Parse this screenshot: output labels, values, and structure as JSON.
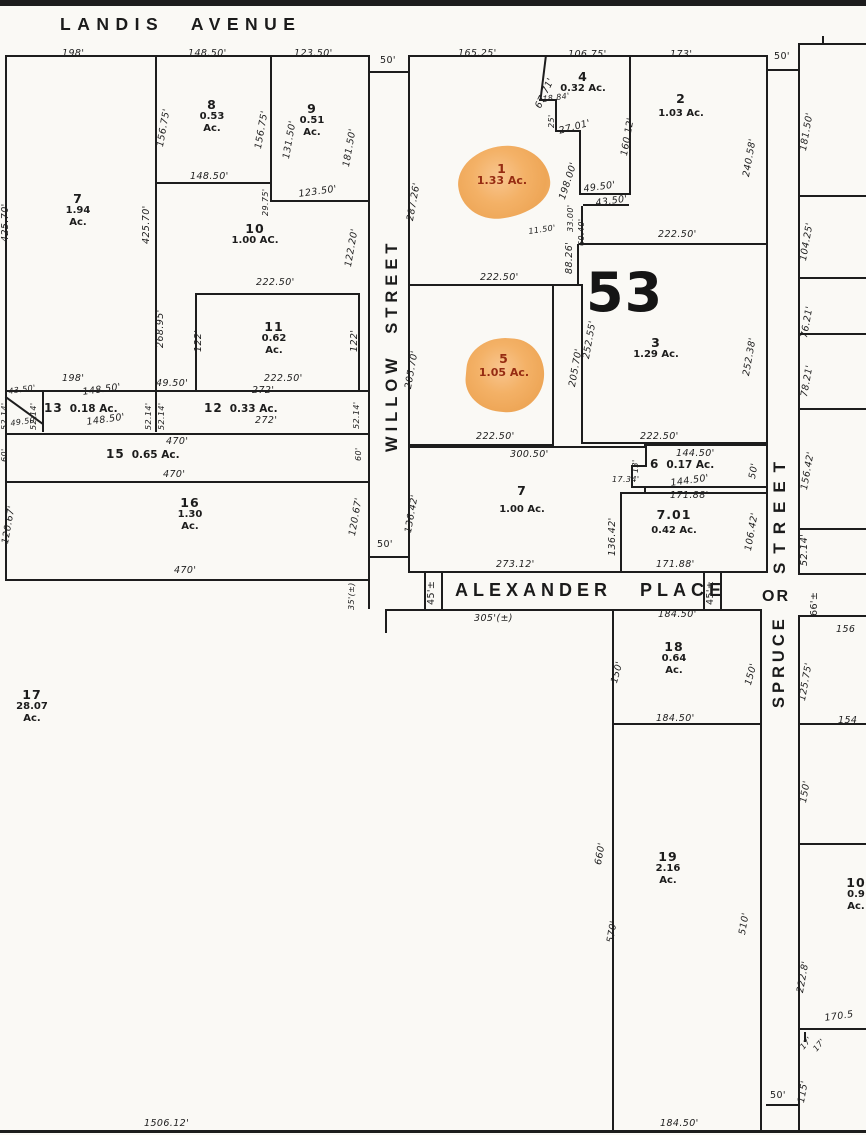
{
  "streets": {
    "landis": "LANDIS AVENUE",
    "willow": "WILLOW STREET",
    "alexander": "ALEXANDER PLACE",
    "spruce_word_street": "STREET",
    "spruce_or": "OR",
    "spruce_word_spruce": "SPRUCE"
  },
  "block_number": "53",
  "colors": {
    "paper": "#faf9f5",
    "line": "#1d1d1d",
    "highlight_fill": "#f0a85a",
    "highlight_text": "#962c12"
  },
  "lots": {
    "l1": {
      "num": "1",
      "ac": "1.33 Ac."
    },
    "l2": {
      "num": "2",
      "ac": "1.03 Ac."
    },
    "l3": {
      "num": "3",
      "ac": "1.29 Ac."
    },
    "l4": {
      "num": "4",
      "ac": "0.32 Ac."
    },
    "l5": {
      "num": "5",
      "ac": "1.05 Ac."
    },
    "l6": {
      "num": "6",
      "ac": "0.17 Ac."
    },
    "l7r": {
      "num": "7",
      "ac": "1.00 Ac."
    },
    "l701": {
      "num": "7.01",
      "ac": "0.42 Ac."
    },
    "l7": {
      "num": "7",
      "ac": "1.94",
      "unit": "Ac."
    },
    "l8": {
      "num": "8",
      "ac": "0.53",
      "unit": "Ac."
    },
    "l9": {
      "num": "9",
      "ac": "0.51",
      "unit": "Ac."
    },
    "l10": {
      "num": "10",
      "ac": "1.00 AC."
    },
    "l11": {
      "num": "11",
      "ac": "0.62",
      "unit": "Ac."
    },
    "l12": {
      "num": "12",
      "ac": "0.33 Ac."
    },
    "l13": {
      "num": "13",
      "ac": "0.18 Ac."
    },
    "l15": {
      "num": "15",
      "ac": "0.65 Ac."
    },
    "l16": {
      "num": "16",
      "ac": "1.30",
      "unit": "Ac."
    },
    "l17": {
      "num": "17",
      "ac": "28.07",
      "unit": "Ac."
    },
    "l18": {
      "num": "18",
      "ac": "0.64",
      "unit": "Ac."
    },
    "l19": {
      "num": "19",
      "ac": "2.16",
      "unit": "Ac."
    },
    "l10e": {
      "num": "10",
      "ac": "0.9",
      "unit": "Ac."
    }
  },
  "dims": [
    "198'",
    "148.50'",
    "123.50'",
    "50'",
    "165.25'",
    "106.75'",
    "173'",
    "50'",
    "425.70'",
    "425.70'",
    "156.75'",
    "156.75'",
    "131.50'",
    "181.50'",
    "287.26'",
    "67.71'",
    "18.84'",
    "25'",
    "27.01'",
    "160.12'",
    "240.58'",
    "148.50'",
    "123.50'",
    "29.75'",
    "122.20'",
    "198.00'",
    "49.50'",
    "43.50'",
    "33.00'",
    "60.40'",
    "11.50'",
    "88.26'",
    "222.50'",
    "268.95'",
    "222.50'",
    "222.50'",
    "122'",
    "122'",
    "205.70'",
    "205.70'",
    "252.55'",
    "252.38'",
    "198'",
    "49.50'",
    "222.50'",
    "43.50'",
    "52.14'",
    "49.50'",
    "52.14'",
    "148.50'",
    "148.50'",
    "52.14'",
    "52.14'",
    "272'",
    "272'",
    "52.14'",
    "470'",
    "470'",
    "60'",
    "60'",
    "120.67'",
    "120.67'",
    "470'",
    "50'",
    "35'(±)",
    "222.50'",
    "222.50'",
    "300.50'",
    "144.50'",
    "13'",
    "17.34'",
    "144.50'",
    "50'",
    "171.88'",
    "136.42'",
    "136.42'",
    "106.42'",
    "273.12'",
    "171.88'",
    "45'±",
    "45'±",
    "305'(±)",
    "184.50'",
    "150'",
    "150'",
    "184.50'",
    "660'",
    "570'",
    "510'",
    "184.50'",
    "1506.12'",
    "50'",
    "181.50'",
    "104.25'",
    "76.21'",
    "78.21'",
    "156.42'",
    "52.14'",
    "66'±",
    "156",
    "125.75'",
    "154",
    "150'",
    "222.8'",
    "170.5",
    "17'",
    "17'",
    "115'"
  ]
}
